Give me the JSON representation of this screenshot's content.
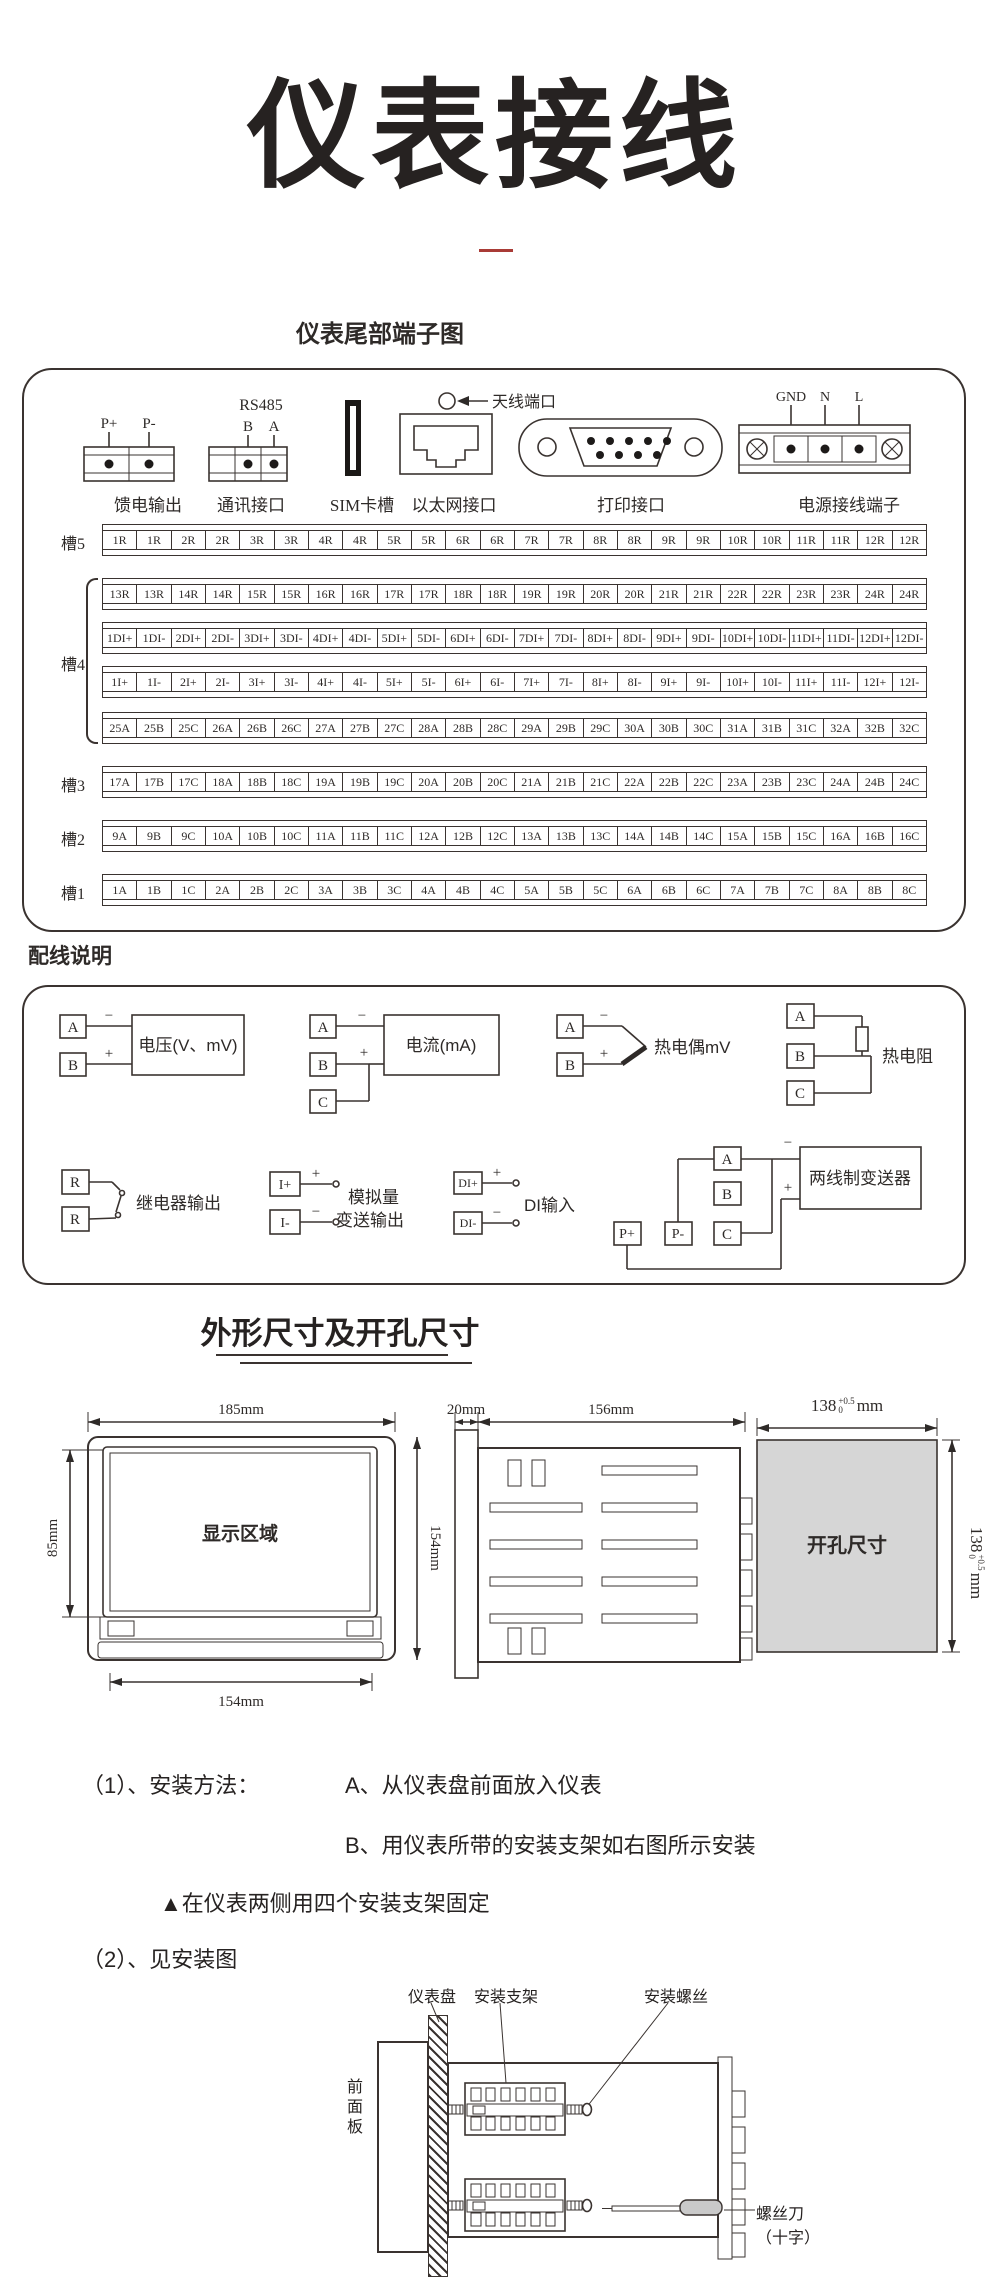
{
  "page": {
    "title": "仪表接线",
    "subtitle": "仪表尾部端子图",
    "wiring_section_title": "配线说明",
    "dimensions_title": "外形尺寸及开孔尺寸"
  },
  "colors": {
    "accent_red": "#a93b36",
    "line": "#3a3330",
    "cutout_gray": "#d6d6d6"
  },
  "rear_panel": {
    "connectors": {
      "feed": {
        "label": "馈电输出",
        "pins": [
          "P+",
          "P-"
        ]
      },
      "comm": {
        "label": "通讯接口",
        "title": "RS485",
        "pins": [
          "B",
          "A"
        ]
      },
      "sim": {
        "label": "SIM卡槽"
      },
      "ethernet": {
        "label": "以太网接口"
      },
      "antenna": {
        "label": "天线端口"
      },
      "printer": {
        "label": "打印接口"
      },
      "power": {
        "label": "电源接线端子",
        "pins": [
          "GND",
          "N",
          "L"
        ]
      }
    },
    "slots": [
      {
        "label": "槽5",
        "rows": [
          [
            "1R",
            "1R",
            "2R",
            "2R",
            "3R",
            "3R",
            "4R",
            "4R",
            "5R",
            "5R",
            "6R",
            "6R",
            "7R",
            "7R",
            "8R",
            "8R",
            "9R",
            "9R",
            "10R",
            "10R",
            "11R",
            "11R",
            "12R",
            "12R"
          ]
        ]
      },
      {
        "label": "槽4",
        "rows": [
          [
            "13R",
            "13R",
            "14R",
            "14R",
            "15R",
            "15R",
            "16R",
            "16R",
            "17R",
            "17R",
            "18R",
            "18R",
            "19R",
            "19R",
            "20R",
            "20R",
            "21R",
            "21R",
            "22R",
            "22R",
            "23R",
            "23R",
            "24R",
            "24R"
          ],
          [
            "1DI+",
            "1DI-",
            "2DI+",
            "2DI-",
            "3DI+",
            "3DI-",
            "4DI+",
            "4DI-",
            "5DI+",
            "5DI-",
            "6DI+",
            "6DI-",
            "7DI+",
            "7DI-",
            "8DI+",
            "8DI-",
            "9DI+",
            "9DI-",
            "10DI+",
            "10DI-",
            "11DI+",
            "11DI-",
            "12DI+",
            "12DI-"
          ],
          [
            "1I+",
            "1I-",
            "2I+",
            "2I-",
            "3I+",
            "3I-",
            "4I+",
            "4I-",
            "5I+",
            "5I-",
            "6I+",
            "6I-",
            "7I+",
            "7I-",
            "8I+",
            "8I-",
            "9I+",
            "9I-",
            "10I+",
            "10I-",
            "11I+",
            "11I-",
            "12I+",
            "12I-"
          ],
          [
            "25A",
            "25B",
            "25C",
            "26A",
            "26B",
            "26C",
            "27A",
            "27B",
            "27C",
            "28A",
            "28B",
            "28C",
            "29A",
            "29B",
            "29C",
            "30A",
            "30B",
            "30C",
            "31A",
            "31B",
            "31C",
            "32A",
            "32B",
            "32C"
          ]
        ]
      },
      {
        "label": "槽3",
        "rows": [
          [
            "17A",
            "17B",
            "17C",
            "18A",
            "18B",
            "18C",
            "19A",
            "19B",
            "19C",
            "20A",
            "20B",
            "20C",
            "21A",
            "21B",
            "21C",
            "22A",
            "22B",
            "22C",
            "23A",
            "23B",
            "23C",
            "24A",
            "24B",
            "24C"
          ]
        ]
      },
      {
        "label": "槽2",
        "rows": [
          [
            "9A",
            "9B",
            "9C",
            "10A",
            "10B",
            "10C",
            "11A",
            "11B",
            "11C",
            "12A",
            "12B",
            "12C",
            "13A",
            "13B",
            "13C",
            "14A",
            "14B",
            "14C",
            "15A",
            "15B",
            "15C",
            "16A",
            "16B",
            "16C"
          ]
        ]
      },
      {
        "label": "槽1",
        "rows": [
          [
            "1A",
            "1B",
            "1C",
            "2A",
            "2B",
            "2C",
            "3A",
            "3B",
            "3C",
            "4A",
            "4B",
            "4C",
            "5A",
            "5B",
            "5C",
            "6A",
            "6B",
            "6C",
            "7A",
            "7B",
            "7C",
            "8A",
            "8B",
            "8C"
          ]
        ]
      }
    ]
  },
  "wiring": {
    "voltage": {
      "terminals": [
        "A",
        "B"
      ],
      "label": "电压(V、mV)",
      "polarity": [
        "−",
        "+"
      ]
    },
    "current": {
      "terminals": [
        "A",
        "B",
        "C"
      ],
      "label": "电流(mA)",
      "polarity": [
        "−",
        "+"
      ]
    },
    "thermocouple": {
      "terminals": [
        "A",
        "B"
      ],
      "label": "热电偶mV",
      "polarity": [
        "−",
        "+"
      ]
    },
    "rtd": {
      "terminals": [
        "A",
        "B",
        "C"
      ],
      "label": "热电阻"
    },
    "relay": {
      "terminals": [
        "R",
        "R"
      ],
      "label": "继电器输出"
    },
    "analog_out": {
      "terminals": [
        "I+",
        "I-"
      ],
      "label_line1": "模拟量",
      "label_line2": "变送输出",
      "polarity": [
        "+",
        "−"
      ]
    },
    "di": {
      "terminals": [
        "DI+",
        "DI-"
      ],
      "label": "DI输入",
      "polarity": [
        "+",
        "−"
      ]
    },
    "transmitter": {
      "terminals": [
        "P+",
        "P-",
        "A",
        "B",
        "C"
      ],
      "label": "两线制变送器",
      "polarity": [
        "−",
        "+"
      ]
    }
  },
  "dimensions": {
    "front": {
      "width": "185mm",
      "display_label": "显示区域",
      "display_height": "85mm",
      "height": "154mm",
      "bottom_width": "154mm"
    },
    "side": {
      "depth": "20mm",
      "body_depth": "156mm"
    },
    "cutout": {
      "label": "开孔尺寸",
      "width_value": "138",
      "tol_plus": "+0.5",
      "tol_minus": "0",
      "unit": "mm"
    }
  },
  "install": {
    "line1_prefix": "（1）、安装方法：",
    "line1_a": "A、从仪表盘前面放入仪表",
    "line2_b": "B、用仪表所带的安装支架如右图所示安装",
    "line3": "▲在仪表两侧用四个安装支架固定",
    "line4": "（2）、见安装图",
    "labels": {
      "panel": "仪表盘",
      "bracket": "安装支架",
      "screw": "安装螺丝",
      "front_panel": "前面板",
      "screwdriver": "螺丝刀",
      "screwdriver2": "（十字）"
    }
  }
}
